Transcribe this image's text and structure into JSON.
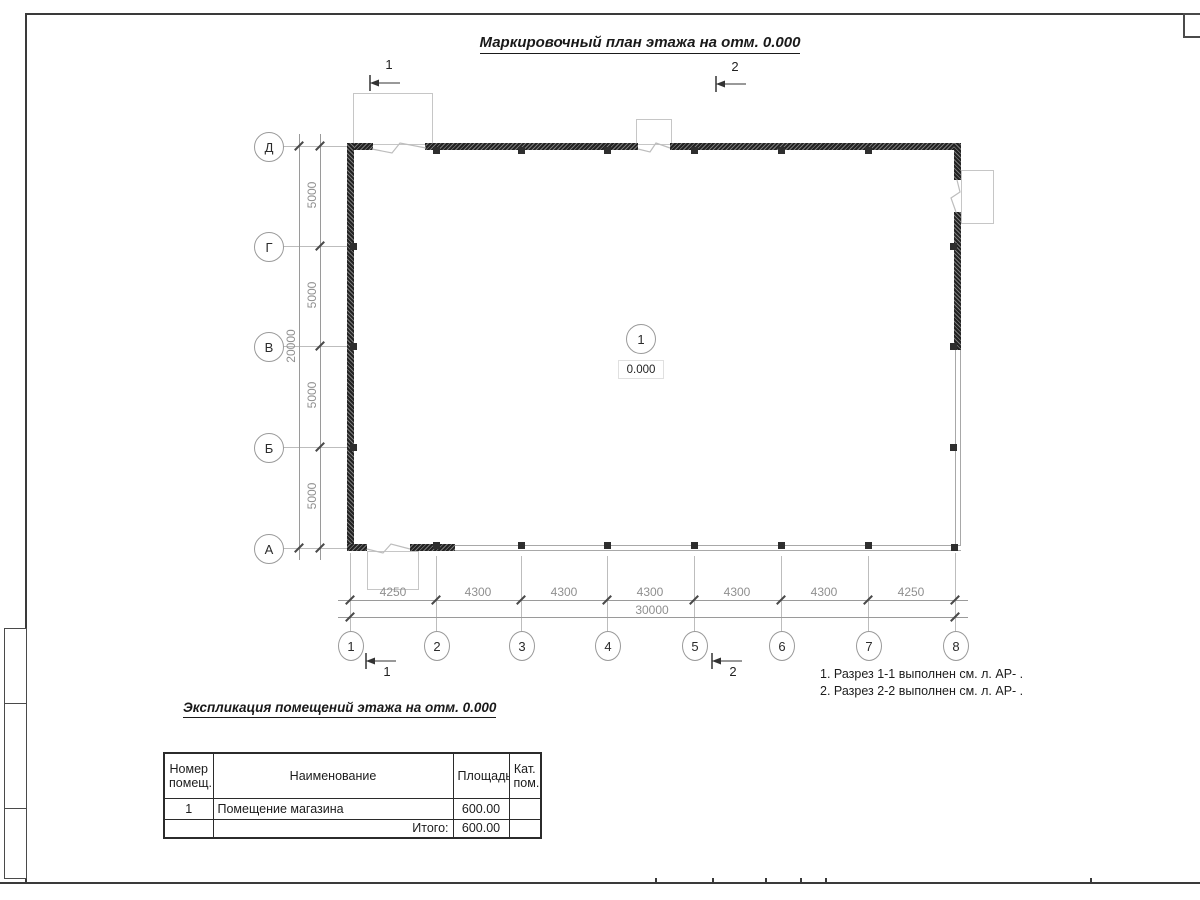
{
  "sheet": {
    "title": "Маркировочный план этажа на отм. 0.000"
  },
  "colors": {
    "frame": "#3a3a3a",
    "wall_hatch": "#1f1f1f",
    "dim_line": "#9a9a9a",
    "dim_text": "#8f8f8f",
    "grid_text": "#2b2b2b"
  },
  "plan": {
    "rows": [
      {
        "label": "Д"
      },
      {
        "label": "Г"
      },
      {
        "label": "В"
      },
      {
        "label": "Б"
      },
      {
        "label": "А"
      }
    ],
    "cols": [
      {
        "label": "1"
      },
      {
        "label": "2"
      },
      {
        "label": "3"
      },
      {
        "label": "4"
      },
      {
        "label": "5"
      },
      {
        "label": "6"
      },
      {
        "label": "7"
      },
      {
        "label": "8"
      }
    ],
    "room_marker": {
      "number": "1",
      "elevation": "0.000"
    }
  },
  "dims": {
    "bottom": {
      "segments": [
        "4250",
        "4300",
        "4300",
        "4300",
        "4300",
        "4300",
        "4250"
      ],
      "total": "30000"
    },
    "left": {
      "segments": [
        "5000",
        "5000",
        "5000",
        "5000"
      ],
      "total": "20000"
    }
  },
  "sections": {
    "top": [
      {
        "number": "1"
      },
      {
        "number": "2"
      }
    ],
    "bottom": [
      {
        "number": "1"
      },
      {
        "number": "2"
      }
    ]
  },
  "notes": [
    "1. Разрез 1-1 выполнен см. л. АР- .",
    "2. Разрез 2-2 выполнен см. л. АР- ."
  ],
  "explication": {
    "heading": "Экспликация помещений этажа на отм. 0.000",
    "columns": [
      "Номер помещ.",
      "Наименование",
      "Площадь",
      "Кат. пом."
    ],
    "rows": [
      {
        "number": "1",
        "name": "Помещение магазина",
        "area": "600.00",
        "category": ""
      }
    ],
    "total_label": "Итого:",
    "total_area": "600.00"
  }
}
